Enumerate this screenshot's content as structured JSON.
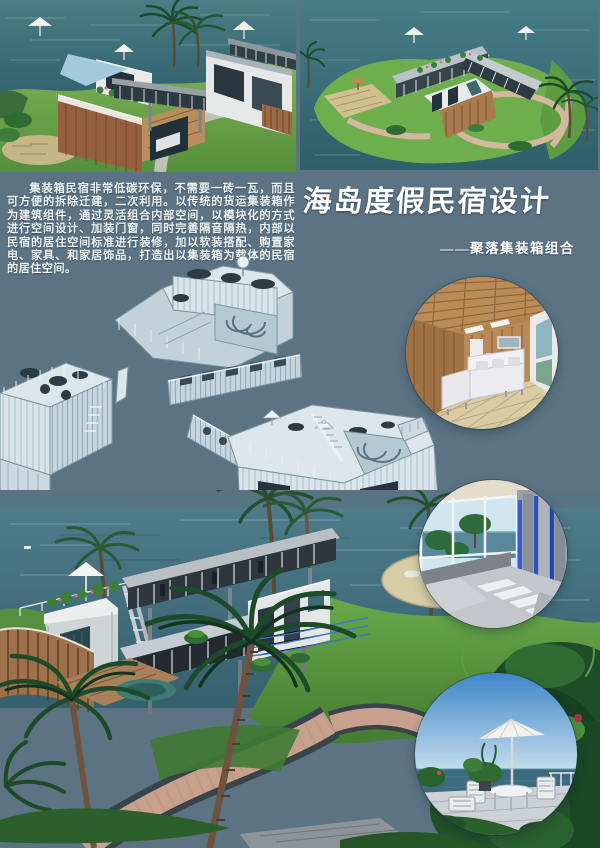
{
  "poster": {
    "title": "海岛度假民宿设计",
    "subtitle": "——聚落集装箱组合",
    "intro_paragraph": "集装箱民宿非常低碳环保，不需要一砖一瓦，而且可方便的拆除迁建，二次利用。以传统的货运集装箱作为建筑组件，通过灵活组合内部空间，以模块化的方式进行空间设计、加装门窗，同时完善隔音隔热，内部以民宿的居住空间标准进行装修，加以软装搭配、购置家电、家具、和家居饰品，打造出以集装箱为载体的民宿的居住空间。",
    "colors": {
      "background": "#5b7383",
      "sea_top": "#45747f",
      "sea_deep": "#2f5f6b",
      "grass": "#6fae4d",
      "wireframe_light": "#d9e5ea",
      "title_text": "#ffffff",
      "wood": "#9c6b45",
      "path_pink": "#c8a18e"
    },
    "images": {
      "top_left": "container-resort-ground-render",
      "top_right": "container-resort-aerial-render",
      "middle": "exploded-container-module-wireframes",
      "bottom": "container-resort-seaside-render",
      "inset_1": "wood-living-room-interior",
      "inset_2": "seaview-bedroom-interior",
      "inset_3": "terrace-umbrella-exterior"
    }
  }
}
